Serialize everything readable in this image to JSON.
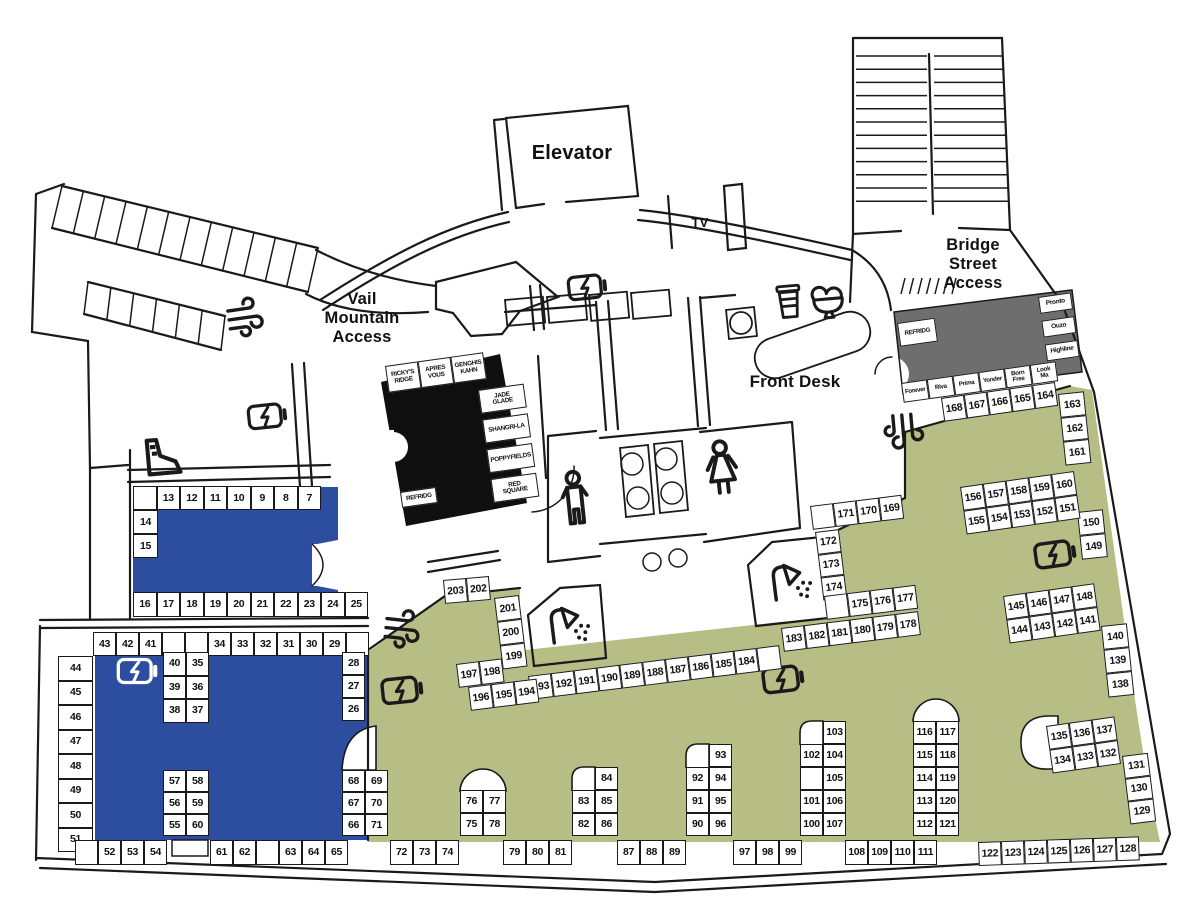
{
  "map": {
    "colors": {
      "blue": "#2d4d9e",
      "olive": "#b6bd85",
      "black_zone": "#0f0f0f",
      "gray_zone": "#6e6e6e",
      "wall": "#1a1a1a",
      "background": "#ffffff"
    },
    "labels": {
      "elevator": "Elevator",
      "tv": "TV",
      "vail_access": "Vail\nMountain\nAccess",
      "bridge_access": "Bridge\nStreet\nAccess",
      "front_desk": "Front Desk"
    },
    "locker_groups": [
      {
        "id": "row-7-13",
        "x": 133,
        "y": 486,
        "cw": 23.5,
        "ch": 24,
        "rows": [
          [
            "",
            "13",
            "12",
            "11",
            "10",
            "9",
            "8",
            "7"
          ]
        ]
      },
      {
        "id": "col-14-15",
        "x": 133,
        "y": 510,
        "cw": 25,
        "ch": 24,
        "rows": [
          [
            "14"
          ],
          [
            "15"
          ]
        ]
      },
      {
        "id": "row-16-25",
        "x": 133,
        "y": 592,
        "cw": 23.5,
        "ch": 25,
        "rows": [
          [
            "16",
            "17",
            "18",
            "19",
            "20",
            "21",
            "22",
            "23",
            "24",
            "25"
          ]
        ]
      },
      {
        "id": "row-29-43",
        "x": 93,
        "y": 632,
        "cw": 23,
        "ch": 24,
        "rows": [
          [
            "43",
            "42",
            "41",
            "",
            "",
            "34",
            "33",
            "32",
            "31",
            "30",
            "29",
            ""
          ]
        ]
      },
      {
        "id": "col-44-51",
        "x": 58,
        "y": 656,
        "cw": 35,
        "ch": 24.5,
        "rows": [
          [
            "44"
          ],
          [
            "45"
          ],
          [
            "46"
          ],
          [
            "47"
          ],
          [
            "48"
          ],
          [
            "49"
          ],
          [
            "50"
          ],
          [
            "51"
          ]
        ]
      },
      {
        "id": "block-35-40",
        "x": 163,
        "y": 652,
        "cw": 23,
        "ch": 23.5,
        "rows": [
          [
            "40",
            "35"
          ],
          [
            "39",
            "36"
          ],
          [
            "38",
            "37"
          ]
        ]
      },
      {
        "id": "col-26-28",
        "x": 342,
        "y": 652,
        "cw": 23,
        "ch": 23,
        "rows": [
          [
            "28"
          ],
          [
            "27"
          ],
          [
            "26"
          ]
        ]
      },
      {
        "id": "block-55-60",
        "x": 163,
        "y": 770,
        "cw": 23,
        "ch": 22,
        "rows": [
          [
            "57",
            "58"
          ],
          [
            "56",
            "59"
          ],
          [
            "55",
            "60"
          ]
        ]
      },
      {
        "id": "col-66-71",
        "x": 342,
        "y": 770,
        "cw": 23,
        "ch": 22,
        "rows": [
          [
            "68",
            "69"
          ],
          [
            "67",
            "70"
          ],
          [
            "66",
            "71"
          ]
        ]
      },
      {
        "id": "row-52-54",
        "x": 75,
        "y": 840,
        "cw": 23,
        "ch": 25,
        "rows": [
          [
            "",
            "52",
            "53",
            "54"
          ]
        ]
      },
      {
        "id": "row-61-65",
        "x": 210,
        "y": 840,
        "cw": 23,
        "ch": 25,
        "rows": [
          [
            "61",
            "62",
            "",
            "63",
            "64",
            "65"
          ]
        ]
      },
      {
        "id": "row-72-74",
        "x": 390,
        "y": 840,
        "cw": 23,
        "ch": 25,
        "rows": [
          [
            "72",
            "73",
            "74"
          ]
        ]
      },
      {
        "id": "pillar-75-78",
        "x": 460,
        "y": 790,
        "cw": 23,
        "ch": 23,
        "rows": [
          [
            "76",
            "77"
          ],
          [
            "75",
            "78"
          ]
        ]
      },
      {
        "id": "row-79-81",
        "x": 503,
        "y": 840,
        "cw": 23,
        "ch": 25,
        "rows": [
          [
            "79",
            "80",
            "81"
          ]
        ]
      },
      {
        "id": "pillar-82-86",
        "x": 572,
        "y": 767,
        "cw": 23,
        "ch": 23,
        "rows": [
          [
            null,
            "84"
          ],
          [
            "83",
            "85"
          ],
          [
            "82",
            "86"
          ]
        ]
      },
      {
        "id": "row-87-89",
        "x": 617,
        "y": 840,
        "cw": 23,
        "ch": 25,
        "rows": [
          [
            "87",
            "88",
            "89"
          ]
        ]
      },
      {
        "id": "pillar-90-96",
        "x": 686,
        "y": 744,
        "cw": 23,
        "ch": 23,
        "rows": [
          [
            null,
            "93"
          ],
          [
            "92",
            "94"
          ],
          [
            "91",
            "95"
          ],
          [
            "90",
            "96"
          ]
        ]
      },
      {
        "id": "row-97-99",
        "x": 733,
        "y": 840,
        "cw": 23,
        "ch": 25,
        "rows": [
          [
            "97",
            "98",
            "99"
          ]
        ]
      },
      {
        "id": "pillar-100-107",
        "x": 800,
        "y": 721,
        "cw": 23,
        "ch": 23,
        "rows": [
          [
            null,
            "103"
          ],
          [
            "102",
            "104"
          ],
          [
            "",
            "105"
          ],
          [
            "101",
            "106"
          ],
          [
            "100",
            "107"
          ]
        ]
      },
      {
        "id": "row-108-111",
        "x": 845,
        "y": 840,
        "cw": 23,
        "ch": 25,
        "rows": [
          [
            "108",
            "109",
            "110",
            "111"
          ]
        ]
      },
      {
        "id": "pillar-112-121",
        "x": 913,
        "y": 721,
        "cw": 23,
        "ch": 23,
        "rows": [
          [
            "116",
            "117"
          ],
          [
            "115",
            "118"
          ],
          [
            "114",
            "119"
          ],
          [
            "113",
            "120"
          ],
          [
            "112",
            "121"
          ]
        ]
      },
      {
        "id": "row-122-128",
        "x": 978,
        "y": 842,
        "angle": -2,
        "cw": 23,
        "ch": 24,
        "rows": [
          [
            "122",
            "123",
            "124",
            "125",
            "126",
            "127",
            "128"
          ]
        ]
      },
      {
        "id": "col-129-131",
        "x": 1122,
        "y": 756,
        "angle": -7,
        "cw": 26,
        "ch": 23,
        "rows": [
          [
            "131"
          ],
          [
            "130"
          ],
          [
            "129"
          ]
        ]
      },
      {
        "id": "block-132-137",
        "x": 1046,
        "y": 726,
        "angle": -8,
        "cw": 23,
        "ch": 24,
        "rows": [
          [
            "135",
            "136",
            "137"
          ],
          [
            "134",
            "133",
            "132"
          ]
        ]
      },
      {
        "id": "col-138-140",
        "x": 1101,
        "y": 626,
        "angle": -6,
        "cw": 26,
        "ch": 24,
        "rows": [
          [
            "140"
          ],
          [
            "139"
          ],
          [
            "138"
          ]
        ]
      },
      {
        "id": "block-141-148",
        "x": 1003,
        "y": 596,
        "angle": -8,
        "cw": 23,
        "ch": 24,
        "rows": [
          [
            "145",
            "146",
            "147",
            "148"
          ],
          [
            "144",
            "143",
            "142",
            "141"
          ]
        ]
      },
      {
        "id": "col-149-150",
        "x": 1077,
        "y": 512,
        "angle": -6,
        "cw": 26,
        "ch": 24,
        "rows": [
          [
            "150"
          ],
          [
            "149"
          ]
        ]
      },
      {
        "id": "block-151-160",
        "x": 960,
        "y": 487,
        "angle": -8,
        "cw": 23,
        "ch": 24,
        "rows": [
          [
            "156",
            "157",
            "158",
            "159",
            "160"
          ],
          [
            "155",
            "154",
            "153",
            "152",
            "151"
          ]
        ]
      },
      {
        "id": "col-161-163",
        "x": 1058,
        "y": 394,
        "angle": -6,
        "cw": 26,
        "ch": 24,
        "rows": [
          [
            "163"
          ],
          [
            "162"
          ],
          [
            "161"
          ]
        ]
      },
      {
        "id": "row-164-168",
        "x": 941,
        "y": 398,
        "angle": -8,
        "cw": 23,
        "ch": 24,
        "rows": [
          [
            "168",
            "167",
            "166",
            "165",
            "164"
          ]
        ]
      },
      {
        "id": "row-169-171",
        "x": 810,
        "y": 506,
        "angle": -7,
        "cw": 23,
        "ch": 24,
        "rows": [
          [
            "",
            "171",
            "170",
            "169"
          ]
        ]
      },
      {
        "id": "col-172-174",
        "x": 815,
        "y": 532,
        "angle": -7,
        "cw": 24,
        "ch": 23,
        "rows": [
          [
            "172"
          ],
          [
            "173"
          ],
          [
            "174"
          ]
        ]
      },
      {
        "id": "row-175-177",
        "x": 824,
        "y": 596,
        "angle": -7,
        "cw": 23,
        "ch": 24,
        "rows": [
          [
            "",
            "175",
            "176",
            "177"
          ]
        ]
      },
      {
        "id": "row-178-183",
        "x": 781,
        "y": 628,
        "angle": -7,
        "cw": 23,
        "ch": 24,
        "rows": [
          [
            "183",
            "182",
            "181",
            "180",
            "179",
            "178"
          ]
        ]
      },
      {
        "id": "row-184-193",
        "x": 528,
        "y": 676,
        "angle": -7,
        "cw": 23,
        "ch": 24,
        "rows": [
          [
            "193",
            "192",
            "191",
            "190",
            "189",
            "188",
            "187",
            "186",
            "185",
            "184",
            ""
          ]
        ]
      },
      {
        "id": "row-197-198",
        "x": 456,
        "y": 664,
        "angle": -7,
        "cw": 23,
        "ch": 24,
        "rows": [
          [
            "197",
            "198"
          ]
        ]
      },
      {
        "id": "row-194-196",
        "x": 468,
        "y": 687,
        "angle": -7,
        "cw": 23,
        "ch": 24,
        "rows": [
          [
            "196",
            "195",
            "194"
          ]
        ]
      },
      {
        "id": "row-202-203",
        "x": 443,
        "y": 580,
        "angle": -5,
        "cw": 23,
        "ch": 24,
        "rows": [
          [
            "203",
            "202"
          ]
        ]
      },
      {
        "id": "col-199-201",
        "x": 494,
        "y": 598,
        "angle": -7,
        "cw": 25,
        "ch": 24,
        "rows": [
          [
            "201"
          ],
          [
            "200"
          ],
          [
            "199"
          ]
        ]
      },
      {
        "id": "black-rooms-top",
        "x": 385,
        "y": 366,
        "angle": -8,
        "cw": 33,
        "ch": 27,
        "fs": 6.3,
        "rows": [
          [
            "RICKY'S\nRIDGE",
            "APRES\nVOUS",
            "GENGHIS\nKAHN"
          ]
        ]
      },
      {
        "id": "black-rooms-right",
        "x": 478,
        "y": 390,
        "angle": -8,
        "cw": 46,
        "ch": 24,
        "fs": 6.3,
        "gap": 6,
        "rows": [
          [
            "JADE\nGLADE"
          ],
          [
            "SHANGRI-LA"
          ],
          [
            "POPPYFIELDS"
          ],
          [
            "RED\nSQUARE"
          ]
        ]
      },
      {
        "id": "black-refrig",
        "x": 400,
        "y": 492,
        "angle": -8,
        "cw": 36,
        "ch": 16,
        "fs": 6.2,
        "rows": [
          [
            "REFRIDG"
          ]
        ]
      },
      {
        "id": "gray-refrig",
        "x": 897,
        "y": 323,
        "angle": -8,
        "cw": 38,
        "ch": 24,
        "fs": 6.2,
        "rows": [
          [
            "REFRIDG"
          ]
        ]
      },
      {
        "id": "gray-rooms-bottom",
        "x": 901,
        "y": 383,
        "angle": -8,
        "cw": 26,
        "ch": 20,
        "fs": 6.2,
        "rows": [
          [
            "Forever",
            "Riva",
            "Prima",
            "Yonder",
            "Born\nFree",
            "Look\nMa"
          ]
        ]
      },
      {
        "id": "gray-rooms-right",
        "x": 1038,
        "y": 297,
        "angle": -8,
        "cw": 33,
        "ch": 17,
        "fs": 6.5,
        "gap": 7,
        "rows": [
          [
            "Pronto"
          ],
          [
            "Ouzo"
          ],
          [
            "Highline"
          ]
        ]
      }
    ],
    "icons": [
      {
        "name": "charging-station-icon",
        "glyph": "charge",
        "x": 588,
        "y": 287,
        "angle": -6,
        "scale": 0.8
      },
      {
        "name": "charging-station-icon",
        "glyph": "charge",
        "x": 268,
        "y": 416,
        "angle": -6,
        "scale": 0.8
      },
      {
        "name": "charging-station-icon",
        "glyph": "charge",
        "x": 138,
        "y": 671,
        "angle": 0,
        "scale": 0.82,
        "color": "#ffffff"
      },
      {
        "name": "charging-station-icon",
        "glyph": "charge",
        "x": 403,
        "y": 690,
        "angle": -6,
        "scale": 0.85
      },
      {
        "name": "charging-station-icon",
        "glyph": "charge",
        "x": 784,
        "y": 679,
        "angle": -7,
        "scale": 0.85
      },
      {
        "name": "charging-station-icon",
        "glyph": "charge",
        "x": 1056,
        "y": 554,
        "angle": -8,
        "scale": 0.85
      },
      {
        "name": "air-dryer-icon",
        "glyph": "wind",
        "x": 243,
        "y": 318,
        "angle": -8,
        "scale": 1
      },
      {
        "name": "air-dryer-icon",
        "glyph": "wind",
        "x": 400,
        "y": 629,
        "angle": 6,
        "scale": 1
      },
      {
        "name": "air-dryer-icon",
        "glyph": "wind",
        "x": 903,
        "y": 429,
        "angle": 85,
        "scale": 1
      },
      {
        "name": "coffee-icon",
        "glyph": "coffee",
        "x": 789,
        "y": 302,
        "angle": -5,
        "scale": 1
      },
      {
        "name": "ice-cream-icon",
        "glyph": "icecream",
        "x": 828,
        "y": 300,
        "angle": -5,
        "scale": 1.1
      },
      {
        "name": "shower-icon",
        "glyph": "shower",
        "x": 567,
        "y": 624,
        "angle": -7,
        "scale": 1.15
      },
      {
        "name": "shower-icon",
        "glyph": "shower",
        "x": 789,
        "y": 581,
        "angle": -7,
        "scale": 1.15
      },
      {
        "name": "ski-boot-icon",
        "glyph": "boot",
        "x": 163,
        "y": 457,
        "angle": -5,
        "scale": 1.35
      },
      {
        "name": "mens-restroom-icon",
        "glyph": "man",
        "x": 575,
        "y": 499,
        "angle": -6,
        "scale": 1.5
      },
      {
        "name": "womens-restroom-icon",
        "glyph": "woman",
        "x": 722,
        "y": 470,
        "angle": -6,
        "scale": 1.5
      }
    ]
  }
}
